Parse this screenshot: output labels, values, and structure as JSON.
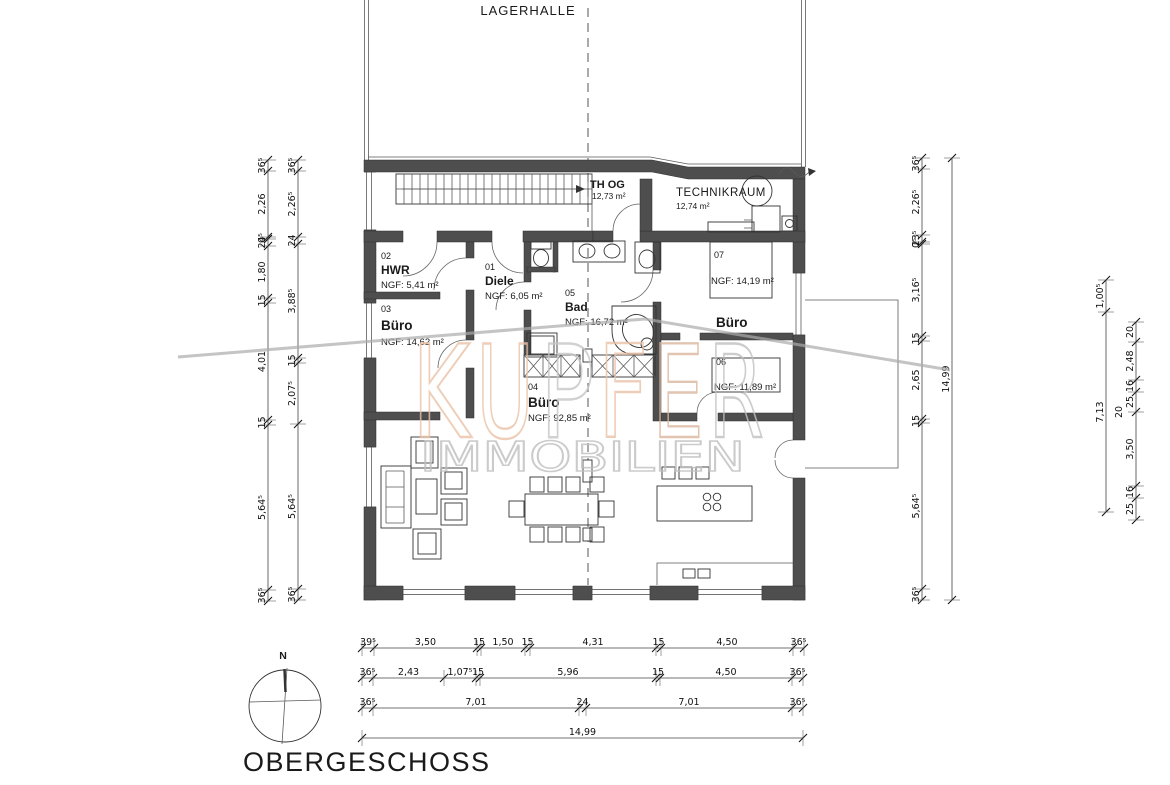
{
  "hall_label": "LAGERHALLE",
  "title": "OBERGESCHOSS",
  "compass_label": "N",
  "rooms": {
    "stair": {
      "name": "TH OG",
      "area": "12,73 m²"
    },
    "technik": {
      "name": "TECHNIKRAUM",
      "area": "12,74 m²"
    },
    "hwr": {
      "number": "02",
      "name": "HWR",
      "area": "NGF: 5,41 m²"
    },
    "diele": {
      "number": "01",
      "name": "Diele",
      "area": "NGF: 6,05 m²"
    },
    "bad": {
      "number": "05",
      "name": "Bad",
      "area": "NGF: 16,72 m²"
    },
    "buero03": {
      "number": "03",
      "name": "Büro",
      "area": "NGF: 14,62 m²"
    },
    "buero07": {
      "number": "07",
      "name": "Büro",
      "area": "NGF: 14,19 m²"
    },
    "buero06": {
      "number": "06",
      "area": "NGF: 11,89 m²"
    },
    "buero04": {
      "number": "04",
      "name": "Büro",
      "area": "NGF: 92,85 m²"
    }
  },
  "watermark": {
    "line2": "IMMOBILIEN",
    "salmon": "#eac3a8",
    "gray": "#c0c0c0",
    "letters": [
      {
        "ch": "K",
        "color": "#eac3a8"
      },
      {
        "ch": "U",
        "color": "#eac3a8"
      },
      {
        "ch": "P",
        "color": "#c6c6c6"
      },
      {
        "ch": "F",
        "color": "#eac3a8"
      },
      {
        "ch": "E",
        "color": "#dcb79e"
      },
      {
        "ch": "R",
        "color": "#c0c0c0"
      }
    ]
  },
  "dims": {
    "left_outer": [
      "36⁵",
      "2,26",
      "0⁵",
      "24",
      "1,80",
      "15",
      "4,01",
      "15",
      "5,64⁵",
      "36⁵"
    ],
    "left_inner": [
      "36⁵",
      "2,26⁵",
      "24",
      "3,88⁵",
      "15",
      "2,07⁵",
      "5,64⁵",
      "36⁵"
    ],
    "right_inner": [
      "36⁵",
      "2,26⁵",
      "23⁵",
      "0⁵",
      "3,16⁵",
      "15",
      "2,65",
      "15",
      "5,64⁵",
      "36⁵"
    ],
    "right_total": "14,99",
    "far_right_a": [
      "1,00⁵",
      "7,13"
    ],
    "far_right_b": [
      "20",
      "2,48",
      "16",
      "25",
      "3,50",
      "16",
      "25"
    ],
    "far_right_c": "20",
    "bottom_row1": [
      "39⁵",
      "3,50",
      "15",
      "1,50",
      "15",
      "4,31",
      "15",
      "4,50",
      "36⁵"
    ],
    "bottom_row2": [
      "36⁵",
      "2,43",
      "1,07⁵",
      "15",
      "5,96",
      "15",
      "4,50",
      "36⁵"
    ],
    "bottom_row3": [
      "36⁵",
      "7,01",
      "24",
      "7,01",
      "36⁵"
    ],
    "bottom_total": "14,99"
  }
}
